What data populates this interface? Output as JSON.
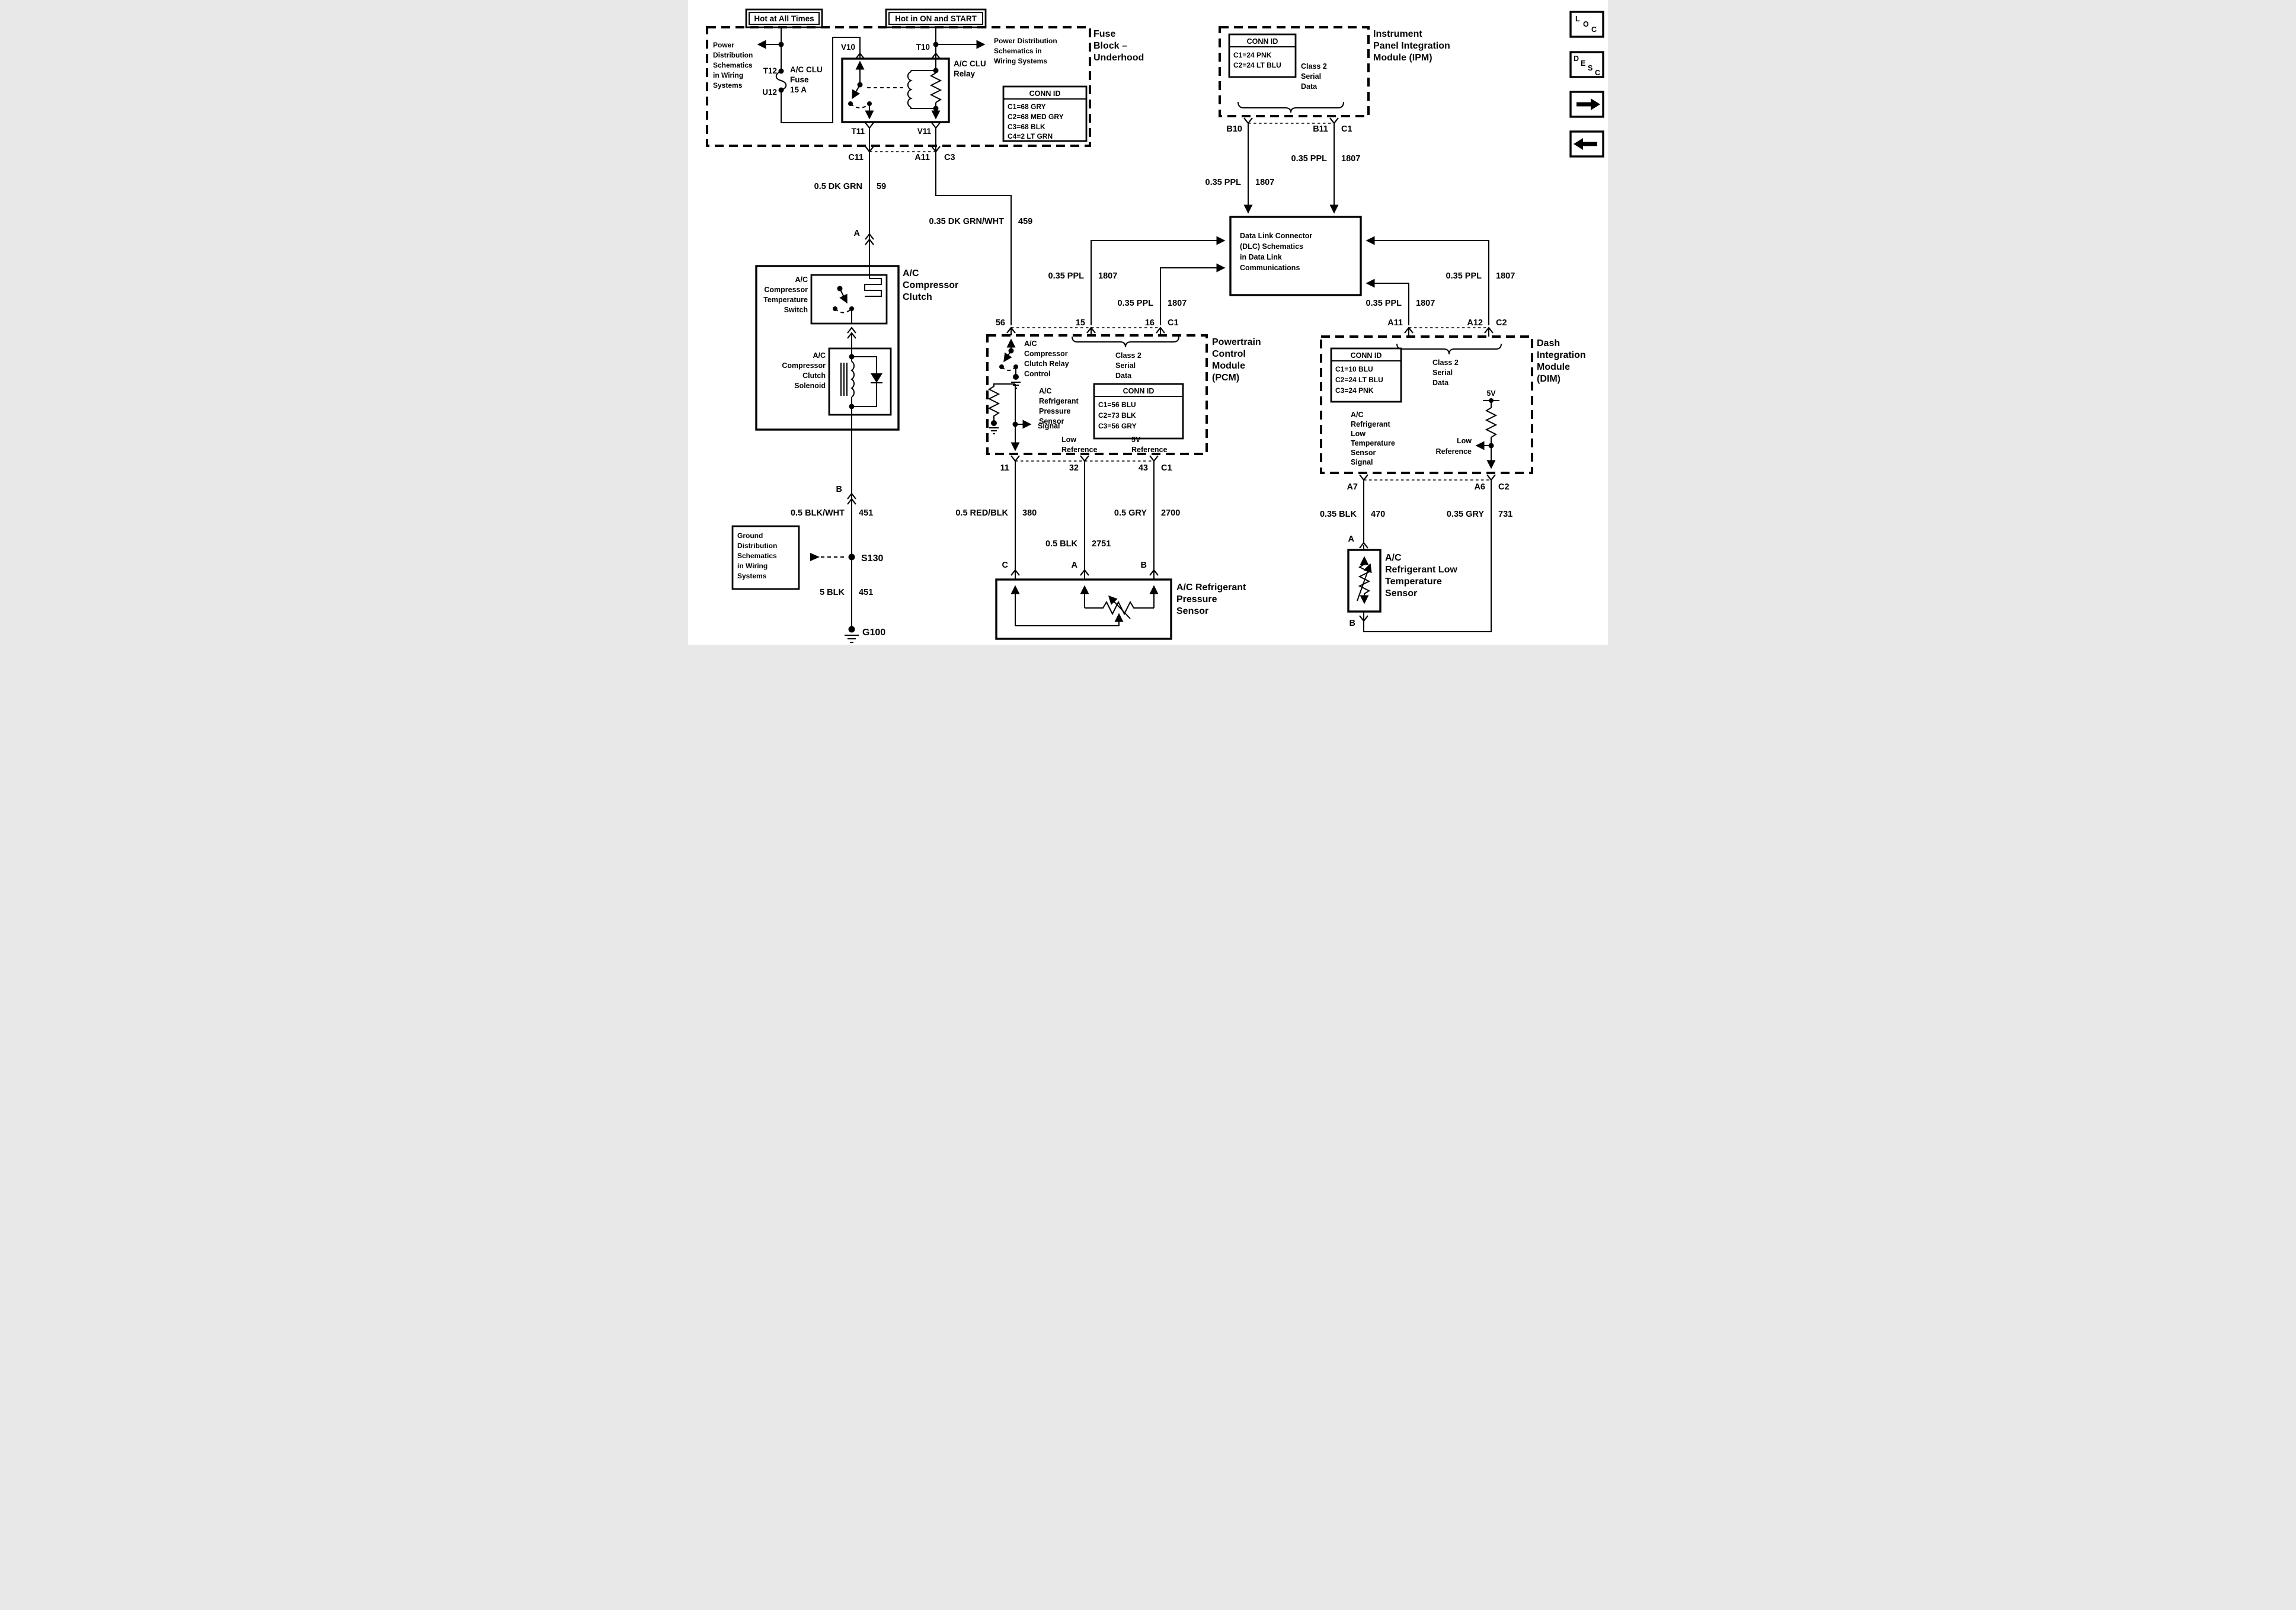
{
  "banners": {
    "hot_at_all_times": "Hot at All Times",
    "hot_in_on_and_start": "Hot in ON and START"
  },
  "nav_buttons": {
    "loc": [
      "L",
      "O",
      "C"
    ],
    "desc": [
      "D",
      "E",
      "S",
      "C"
    ]
  },
  "fuse_block": {
    "title_lines": [
      "Fuse",
      "Block –",
      "Underhood"
    ],
    "power_dist_left_lines": [
      "Power",
      "Distribution",
      "Schematics",
      "in Wiring",
      "Systems"
    ],
    "power_dist_right_lines": [
      "Power Distribution",
      "Schematics in",
      "Wiring Systems"
    ],
    "fuse_lines": [
      "A/C CLU",
      "Fuse",
      "15 A"
    ],
    "relay_lines": [
      "A/C CLU",
      "Relay"
    ],
    "pins": {
      "t12": "T12",
      "u12": "U12",
      "v10": "V10",
      "t10": "T10",
      "t11": "T11",
      "v11": "V11"
    },
    "connector": {
      "c11": "C11",
      "a11": "A11",
      "c3": "C3"
    },
    "conn_id": {
      "title": "CONN ID",
      "rows": [
        "C1=68 GRY",
        "C2=68 MED GRY",
        "C3=68 BLK",
        "C4=2 LT GRN"
      ]
    }
  },
  "wires": {
    "dk_grn_59": {
      "gauge": "0.5 DK GRN",
      "circuit": "59"
    },
    "dk_grn_wht_459": {
      "gauge": "0.35 DK GRN/WHT",
      "circuit": "459"
    },
    "ppl_1807": {
      "gauge": "0.35 PPL",
      "circuit": "1807"
    },
    "red_blk_380": {
      "gauge": "0.5 RED/BLK",
      "circuit": "380"
    },
    "blk_2751": {
      "gauge": "0.5 BLK",
      "circuit": "2751"
    },
    "gry_2700": {
      "gauge": "0.5 GRY",
      "circuit": "2700"
    },
    "blk_470": {
      "gauge": "0.35 BLK",
      "circuit": "470"
    },
    "gry_731": {
      "gauge": "0.35 GRY",
      "circuit": "731"
    },
    "blk_wht_451": {
      "gauge": "0.5 BLK/WHT",
      "circuit": "451"
    },
    "blk_451": {
      "gauge": "5 BLK",
      "circuit": "451"
    }
  },
  "inline_connectors": {
    "a_clutch": "A",
    "b_clutch": "B",
    "a_lts": "A",
    "b_lts": "B"
  },
  "grounds": {
    "s130": "S130",
    "g100": "G100",
    "box_lines": [
      "Ground",
      "Distribution",
      "Schematics",
      "in Wiring",
      "Systems"
    ]
  },
  "ipm": {
    "title_lines": [
      "Instrument",
      "Panel Integration",
      "Module (IPM)"
    ],
    "conn_id": {
      "title": "CONN ID",
      "rows": [
        "C1=24 PNK",
        "C2=24 LT BLU"
      ]
    },
    "class2_lines": [
      "Class 2",
      "Serial",
      "Data"
    ],
    "pins": {
      "b10": "B10",
      "b11": "B11",
      "c1": "C1"
    }
  },
  "dlc": {
    "label_lines": [
      "Data Link Connector",
      "(DLC) Schematics",
      "in Data Link",
      "Communications"
    ]
  },
  "clutch": {
    "title_lines": [
      "A/C",
      "Compressor",
      "Clutch"
    ],
    "temp_switch_lines": [
      "A/C",
      "Compressor",
      "Temperature",
      "Switch"
    ],
    "solenoid_lines": [
      "A/C",
      "Compressor",
      "Clutch",
      "Solenoid"
    ]
  },
  "pcm": {
    "title_lines": [
      "Powertrain",
      "Control",
      "Module",
      "(PCM)"
    ],
    "pins_top": {
      "p56": "56",
      "p15": "15",
      "p16": "16",
      "c1": "C1"
    },
    "pins_bottom": {
      "p11": "11",
      "p32": "32",
      "p43": "43",
      "c1": "C1"
    },
    "relay_control_lines": [
      "A/C",
      "Compressor",
      "Clutch Relay",
      "Control"
    ],
    "class2_lines": [
      "Class 2",
      "Serial",
      "Data"
    ],
    "conn_id": {
      "title": "CONN ID",
      "rows": [
        "C1=56 BLU",
        "C2=73 BLK",
        "C3=56 GRY"
      ]
    },
    "pressure_signal_lines": [
      "A/C",
      "Refrigerant",
      "Pressure",
      "Sensor",
      "Signal"
    ],
    "low_ref_lines": [
      "Low",
      "Reference"
    ],
    "ref_5v_lines": [
      "5V",
      "Reference"
    ]
  },
  "pressure_sensor": {
    "title_lines": [
      "A/C Refrigerant",
      "Pressure",
      "Sensor"
    ],
    "pins": {
      "c": "C",
      "a": "A",
      "b": "B"
    }
  },
  "dim": {
    "title_lines": [
      "Dash",
      "Integration",
      "Module",
      "(DIM)"
    ],
    "conn_id": {
      "title": "CONN ID",
      "rows": [
        "C1=10 BLU",
        "C2=24 LT BLU",
        "C3=24 PNK"
      ]
    },
    "class2_lines": [
      "Class 2",
      "Serial",
      "Data"
    ],
    "pins_top": {
      "a11": "A11",
      "a12": "A12",
      "c2": "C2"
    },
    "pins_bottom": {
      "a7": "A7",
      "a6": "A6",
      "c2": "C2"
    },
    "signal_lines": [
      "A/C",
      "Refrigerant",
      "Low",
      "Temperature",
      "Sensor",
      "Signal"
    ],
    "v5": "5V",
    "low_ref_lines": [
      "Low",
      "Reference"
    ]
  },
  "lts": {
    "title_lines": [
      "A/C",
      "Refrigerant Low",
      "Temperature",
      "Sensor"
    ]
  }
}
